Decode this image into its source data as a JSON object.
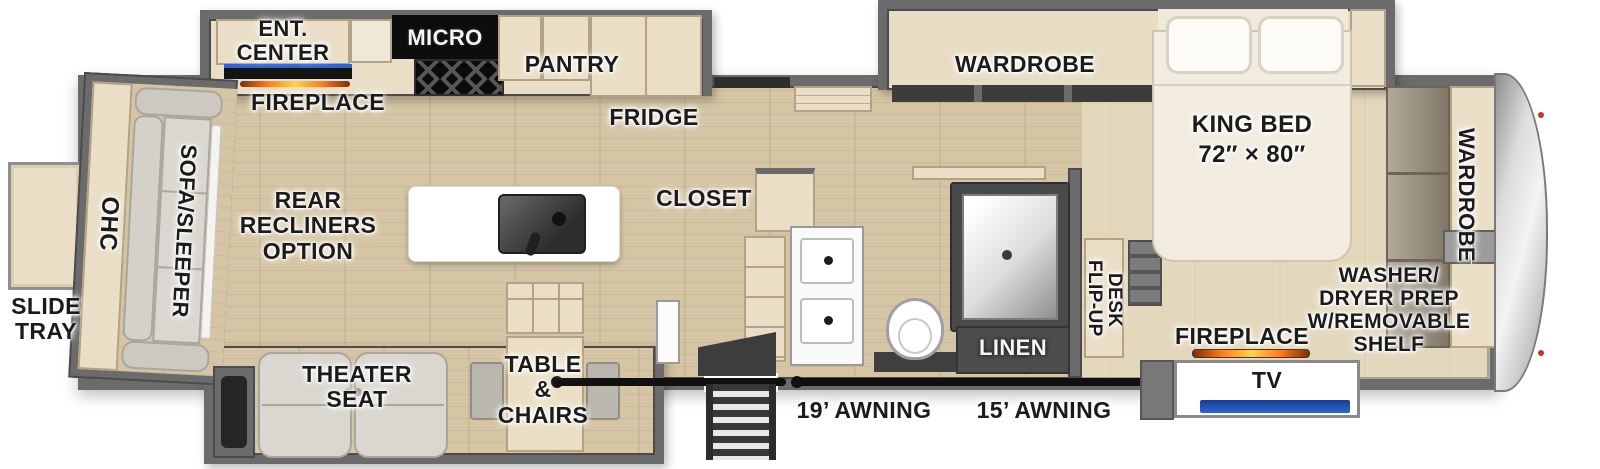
{
  "title": "Fifth wheel RV floor plan diagram",
  "colors": {
    "wall": "#6b6b6b",
    "wallDark": "#4b4b4b",
    "floor": "#d5c5a4",
    "floorLight": "#e6dcc2",
    "cab": "#eadfc6",
    "cabEdge": "#b3a284",
    "ink": "#1b1b1b",
    "sofa": "#d9d7cf",
    "sofaEdge": "#a9a79c",
    "fireOrange": "#ff7b1e",
    "tvBlue": "#2b57b8",
    "steel": "#9c9c9c",
    "darkFix": "#474747",
    "taupe": "#978c79"
  },
  "labels": {
    "slide_tray": "SLIDE\nTRAY",
    "ohc": "OHC",
    "sofa_sleeper": "SOFA/SLEEPER",
    "ent_center": "ENT.\nCENTER",
    "fireplace_living": "FIREPLACE",
    "micro": "MICRO",
    "pantry": "PANTRY",
    "fridge": "FRIDGE",
    "rear_recliners_option": "REAR\nRECLINERS\nOPTION",
    "closet": "CLOSET",
    "theater_seat": "THEATER\nSEAT",
    "table_chairs": "TABLE\n&\nCHAIRS",
    "awning_19": "19’ AWNING",
    "awning_15": "15’ AWNING",
    "linen": "LINEN",
    "flip_up": "FLIP-UP",
    "desk": "DESK",
    "wardrobe_bedroom": "WARDROBE",
    "king_bed": "KING BED\n72″ × 80″",
    "fireplace_bedroom": "FIREPLACE",
    "tv": "TV",
    "washer_dryer_prep": "WASHER/\nDRYER PREP\nW/REMOVABLE\nSHELF",
    "wardrobe_front": "WARDROBE"
  }
}
